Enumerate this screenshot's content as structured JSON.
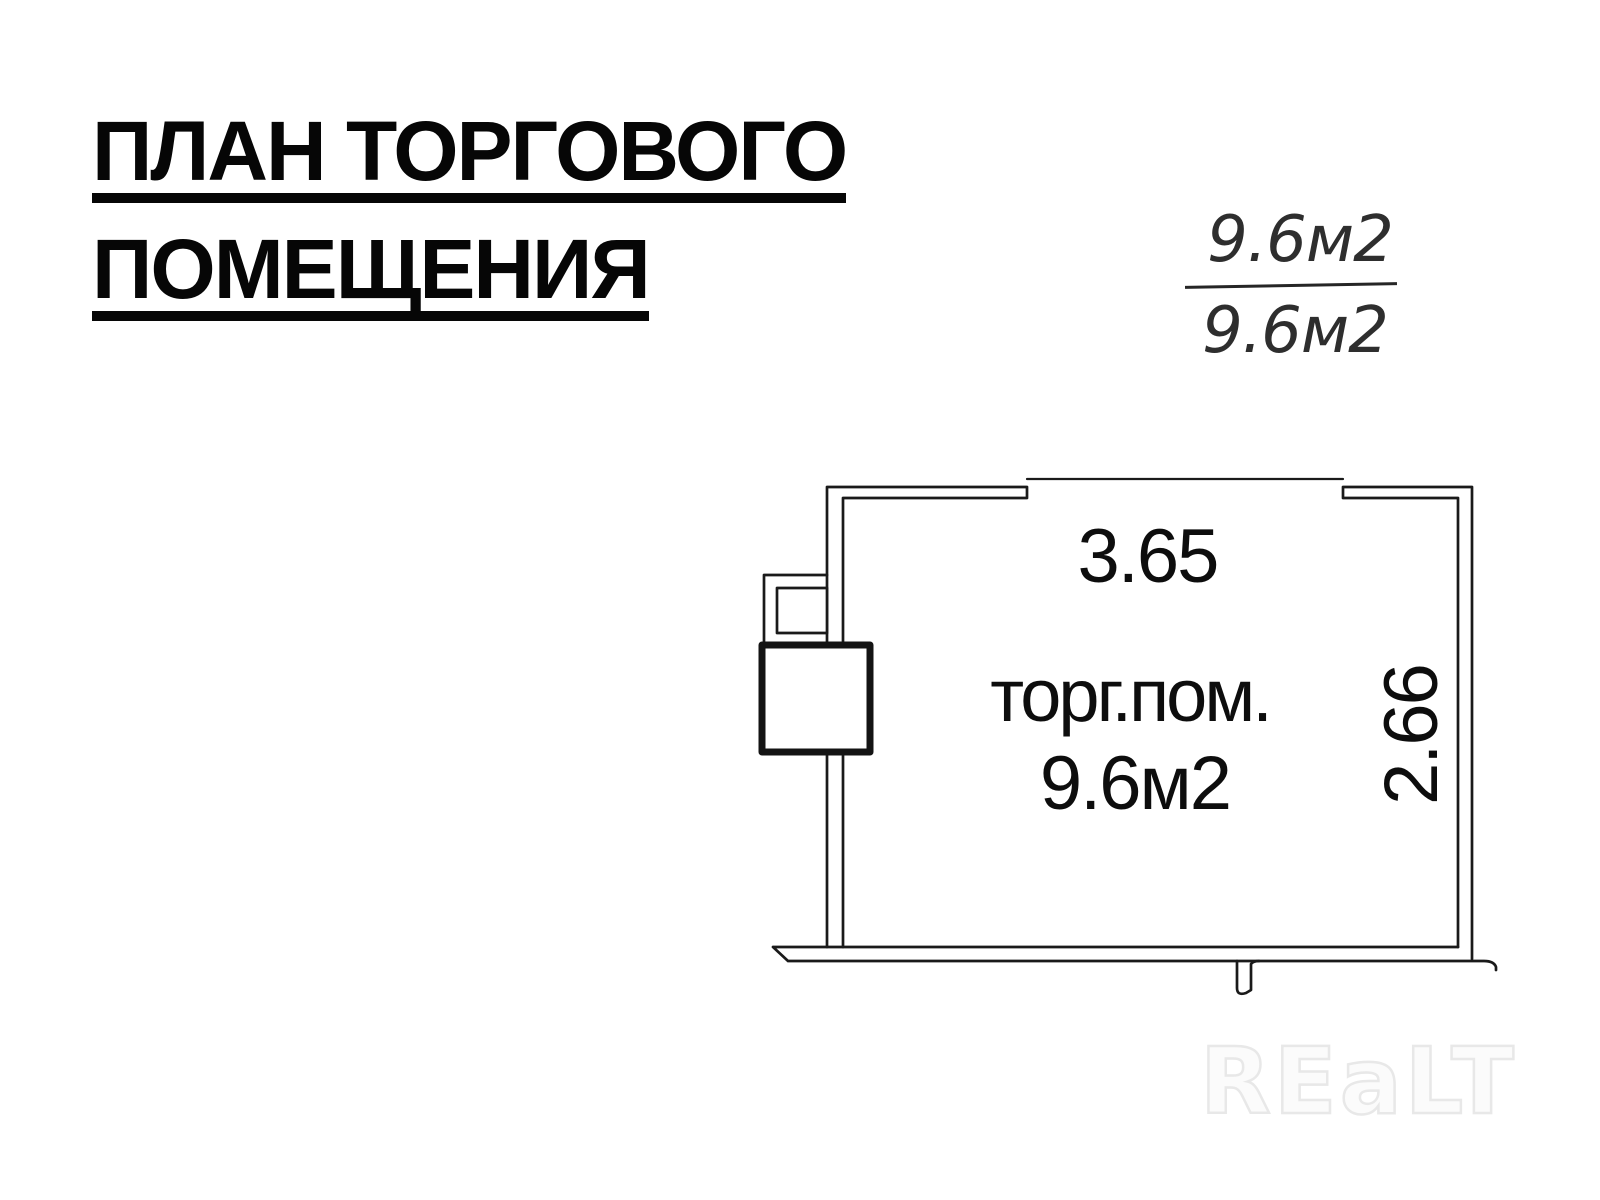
{
  "title": {
    "line1": "ПЛАН ТОРГОВОГО",
    "line2": "ПОМЕЩЕНИЯ"
  },
  "area_fraction": {
    "numerator": "9.6м2",
    "denominator": "9.6м2"
  },
  "plan": {
    "top_dimension": "3.65",
    "right_dimension": "2.66",
    "room_name": "торг.пом.",
    "room_area": "9.6м2"
  },
  "watermark": {
    "text": "REaLT"
  },
  "colors": {
    "ink": "#1a1a1a",
    "label_text": "#0d0d0d",
    "handwriting": "#2e2e2e",
    "watermark_stroke": "#e8e8e8",
    "watermark_fill": "#fbfbfb"
  }
}
